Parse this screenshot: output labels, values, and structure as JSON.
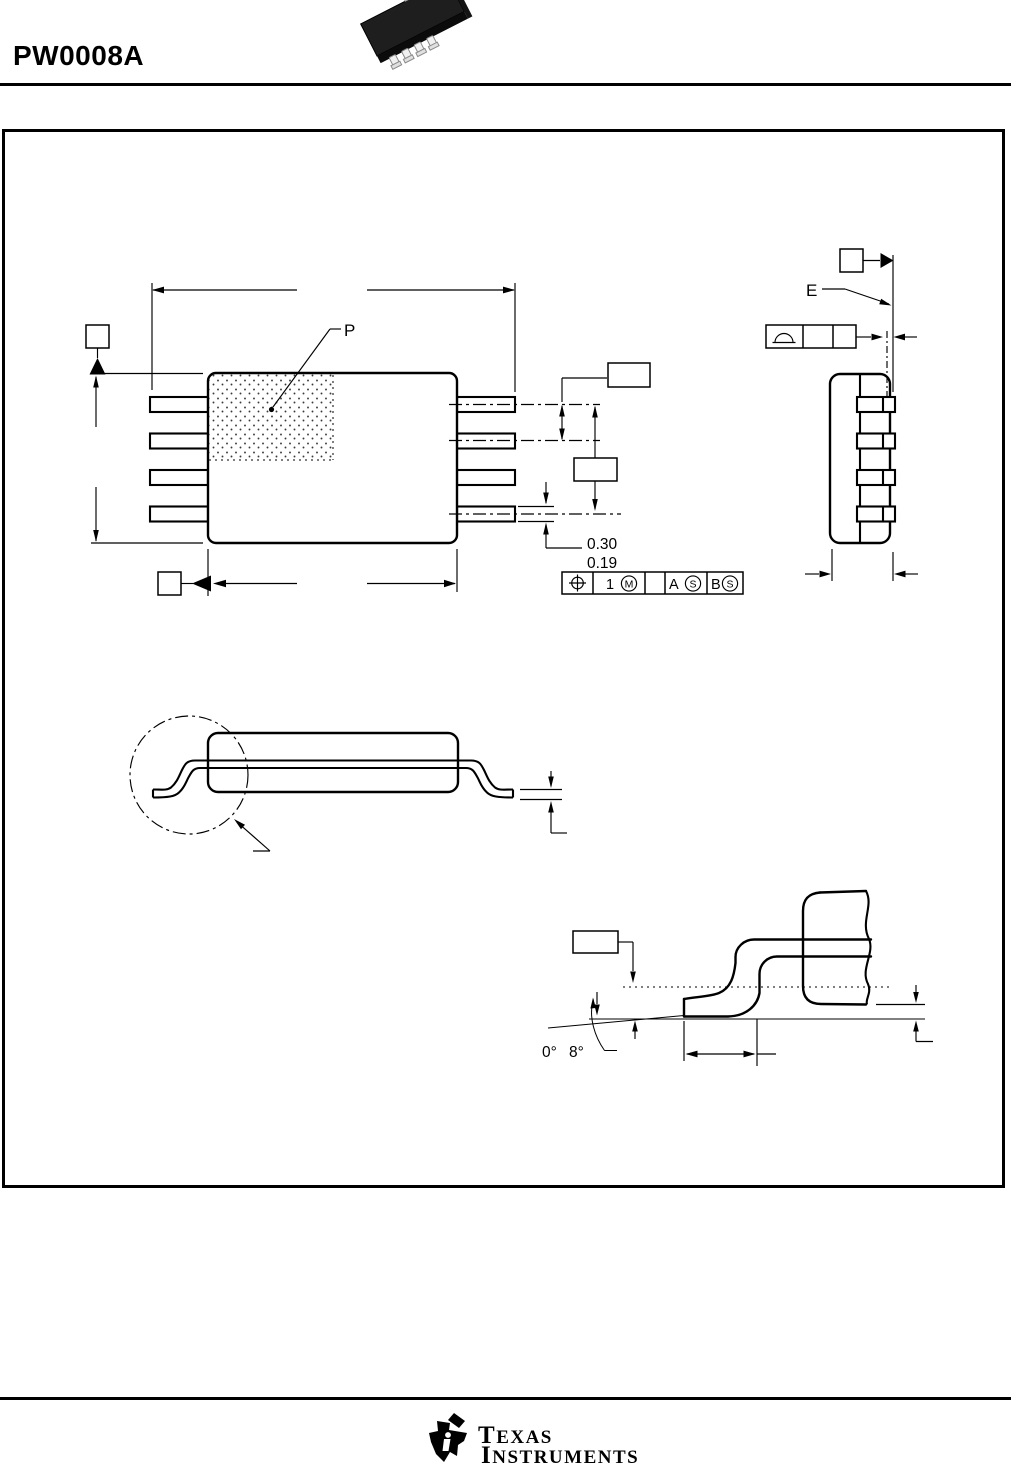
{
  "header": {
    "title": "PW0008A"
  },
  "top_view": {
    "index_area_label": "P",
    "lead_width": {
      "max": "0.30",
      "min": "0.19"
    },
    "position_fcf": {
      "tolerance": "1",
      "tolerance_modifier": "M",
      "datum_a": "A",
      "datum_a_modifier": "S",
      "datum_b": "B",
      "datum_b_modifier": "S"
    }
  },
  "end_view": {
    "datum_label": "E"
  },
  "detail_view": {
    "angle_min": "0°",
    "angle_max": "8°"
  },
  "footer": {
    "brand_initial_1": "T",
    "brand_rest_1": "EXAS",
    "brand_initial_2": "I",
    "brand_rest_2": "NSTRUMENTS"
  }
}
